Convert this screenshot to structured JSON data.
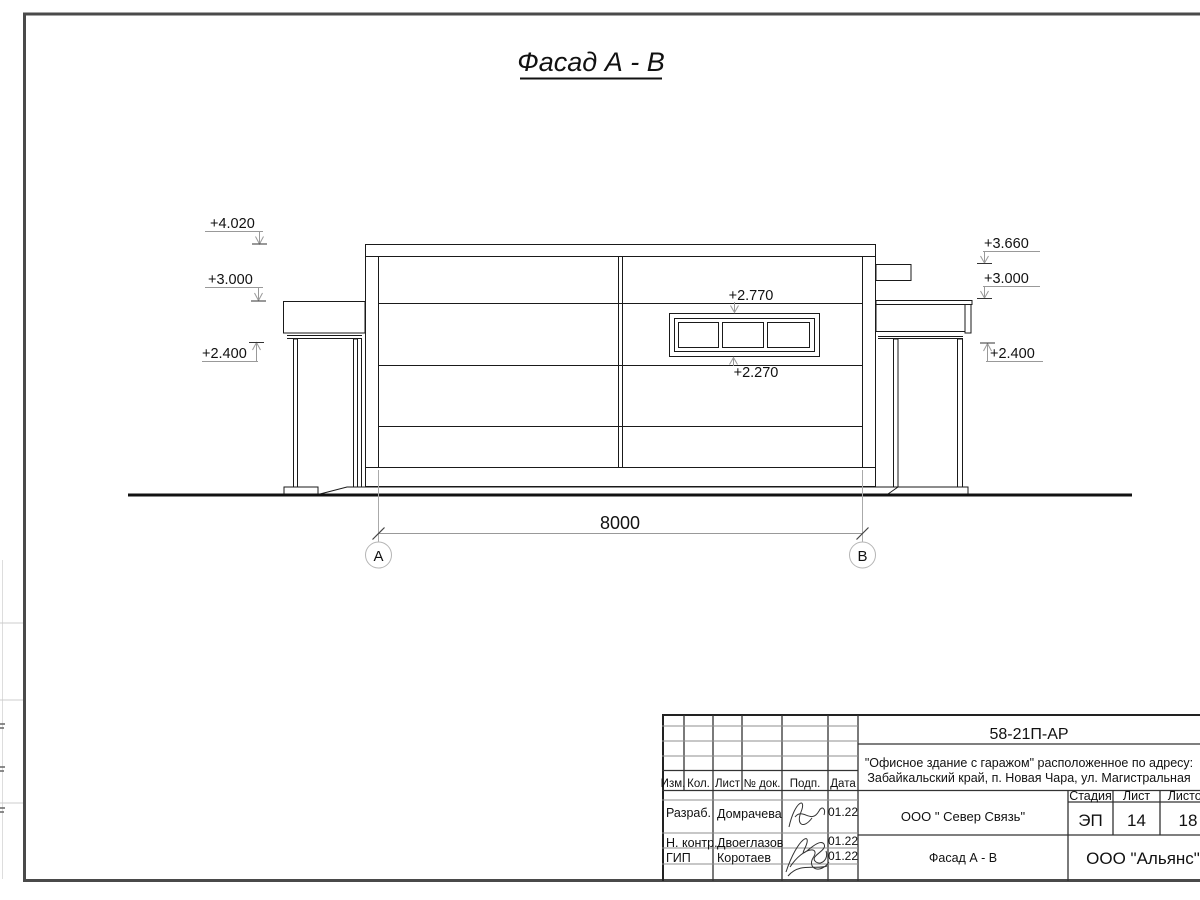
{
  "sheet": {
    "title": "Фасад А - В"
  },
  "drawing": {
    "dimension_label": "8000",
    "axis_left": "А",
    "axis_right": "В",
    "elevations": {
      "left": [
        "+4.020",
        "+3.000",
        "+2.400"
      ],
      "right": [
        "+3.660",
        "+3.000",
        "+2.400"
      ],
      "window_top": "+2.770",
      "window_bottom": "+2.270"
    }
  },
  "title_block": {
    "doc_code": "58-21П-АР",
    "project_line1": "\"Офисное здание с гаражом\" расположенное по адресу:",
    "project_line2": "Забайкальский край, п. Новая Чара, ул. Магистральная",
    "header": {
      "izm": "Изм.",
      "kol": "Кол.",
      "list": "Лист",
      "doc": "№ док.",
      "podp": "Подп.",
      "data": "Дата"
    },
    "rows": [
      {
        "role": "Разраб.",
        "name": "Домрачева",
        "date": "01.22"
      },
      {
        "role": "Н. контр.",
        "name": "Двоеглазов",
        "date": "01.22"
      },
      {
        "role": "ГИП",
        "name": "Коротаев",
        "date": "01.22"
      }
    ],
    "org": "ООО \" Север Связь\"",
    "stage_label": "Стадия",
    "sheet_label": "Лист",
    "sheets_label": "Листов",
    "stage": "ЭП",
    "sheet_no": "14",
    "sheets_total": "18",
    "drawing_name": "Фасад А - В",
    "company": "ООО \"Альянс\""
  }
}
